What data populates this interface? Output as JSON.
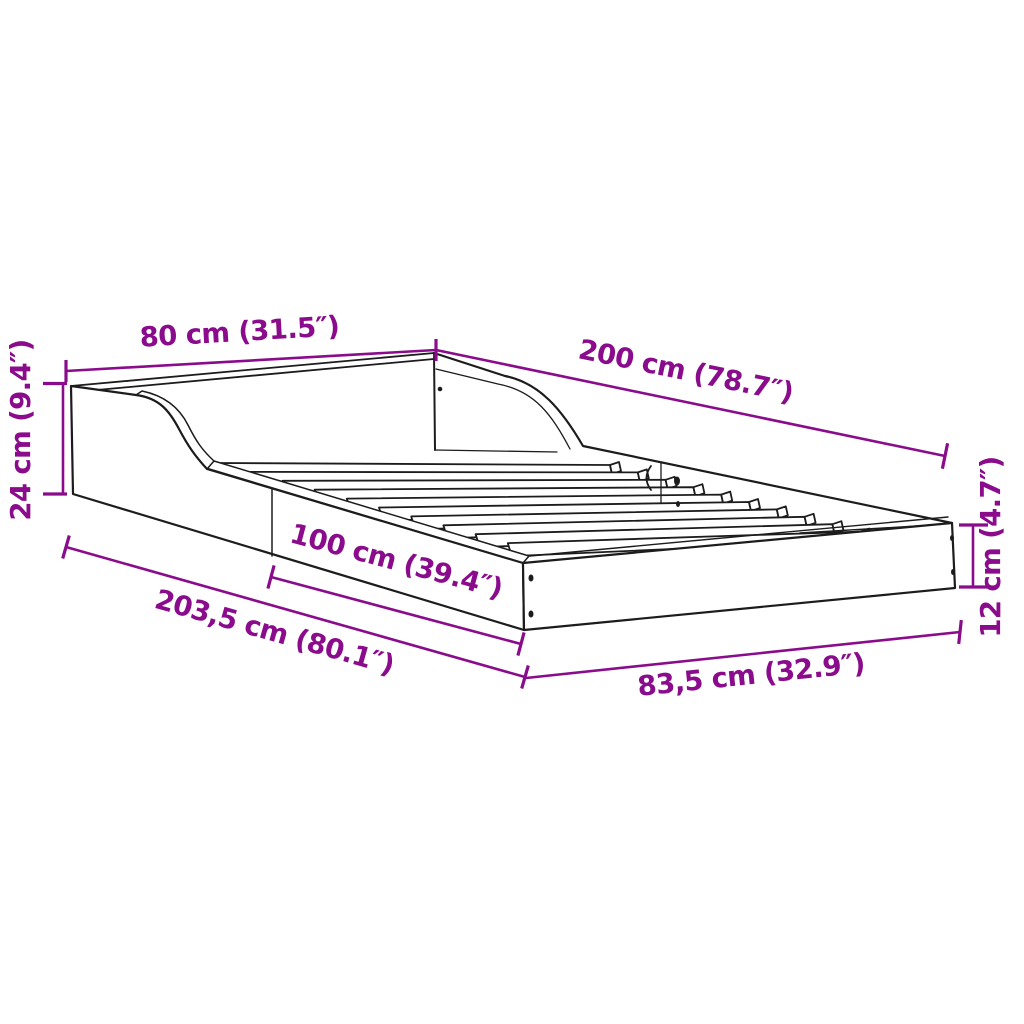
{
  "diagram": {
    "title": "Bed frame dimension diagram",
    "subject": "bed-frame-with-curved-headboard-and-slats",
    "background_color": "#ffffff",
    "line_color": "#1c1c1c",
    "accent_color": "#8A0C8C",
    "face_color": "#ffffff",
    "slat_count": 10,
    "dimensions": {
      "headboard_width": {
        "label": "80 cm (31.5″)",
        "cm": "80 cm",
        "inches": "31.5″"
      },
      "bed_length": {
        "label": "200 cm (78.7″)",
        "cm": "200 cm",
        "inches": "78.7″"
      },
      "headboard_height": {
        "label": "24 cm (9.4″)",
        "cm": "24 cm",
        "inches": "9.4″"
      },
      "rail_section_length": {
        "label": "100 cm (39.4″)",
        "cm": "100 cm",
        "inches": "39.4″"
      },
      "total_length": {
        "label": "203,5 cm (80.1″)",
        "cm": "203,5 cm",
        "inches": "80.1″"
      },
      "total_width": {
        "label": "83,5 cm (32.9″)",
        "cm": "83,5 cm",
        "inches": "32.9″"
      },
      "side_rail_height": {
        "label": "12 cm (4.7″)",
        "cm": "12 cm",
        "inches": "4.7″"
      }
    }
  }
}
